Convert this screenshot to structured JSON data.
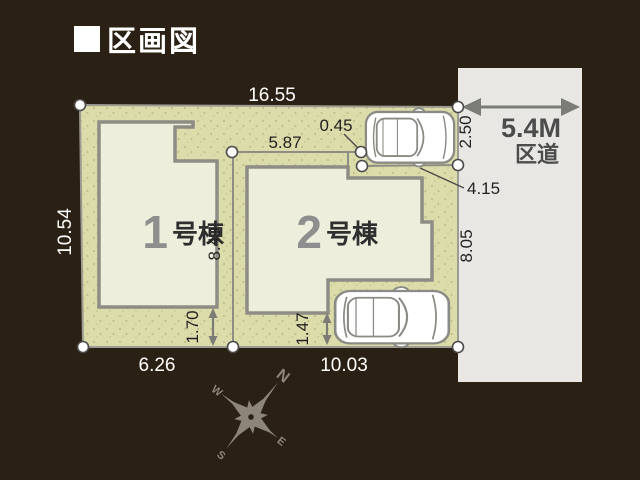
{
  "title": "区画図",
  "road": {
    "width_label": "5.4M",
    "type_label": "区道"
  },
  "plot": {
    "dimensions": {
      "top": "16.55",
      "left": "10.54",
      "bottom_left": "6.26",
      "bottom_right": "10.03",
      "divider": "8.49",
      "parking_top": "5.87",
      "offset_top": "0.45",
      "entrance_right": "4.15",
      "right_upper": "2.50",
      "right_lower": "8.05",
      "building1_setback": "1.70",
      "building2_setback": "1.47"
    },
    "buildings": [
      {
        "number": "1",
        "suffix": "号棟"
      },
      {
        "number": "2",
        "suffix": "号棟"
      }
    ]
  },
  "compass": {
    "n": "N",
    "e": "E",
    "s": "S",
    "w": "W"
  },
  "colors": {
    "background": "#2b2014",
    "lot_fill": "#dcdbaa",
    "building_fill": "#eeeedd",
    "road_fill": "#e8e7e3",
    "line_gray": "#8d8d85",
    "accent_text": "#4c4c4c"
  }
}
